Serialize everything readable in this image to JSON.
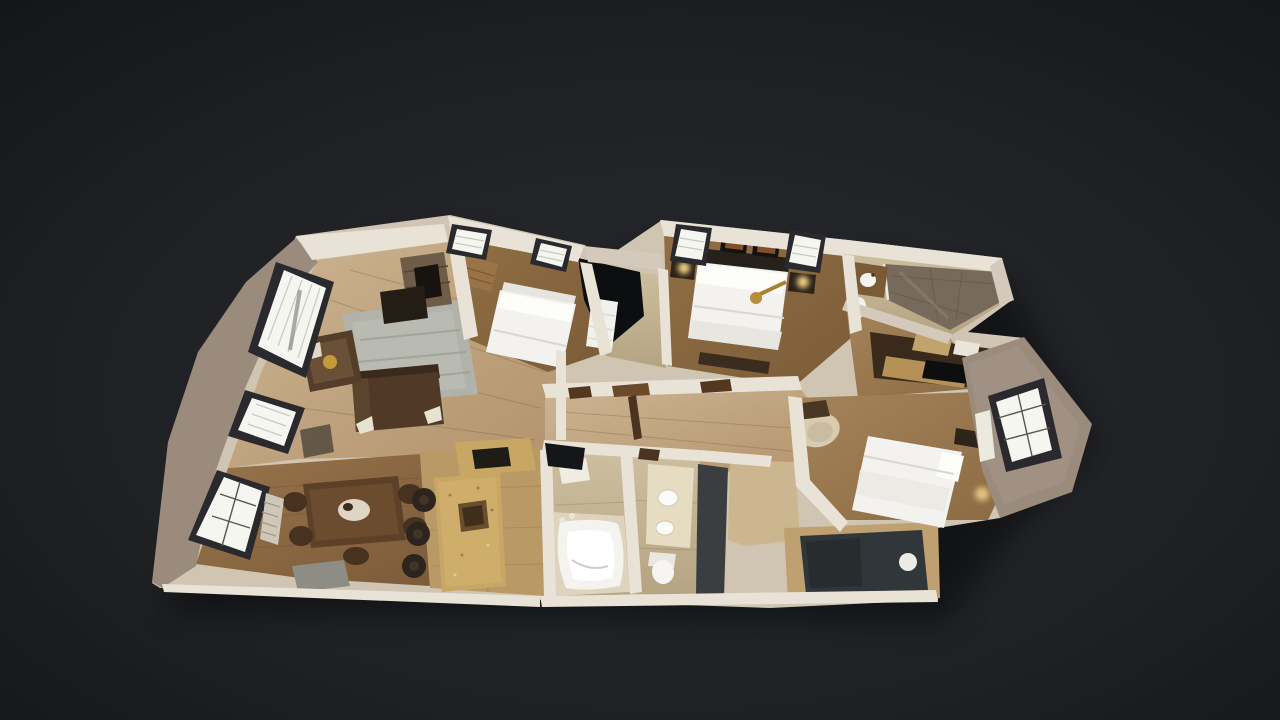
{
  "app": {
    "name": "3D virtual tour viewer",
    "view_mode": "Dollhouse view",
    "background_color": "#1d1f22"
  },
  "scene": {
    "type": "3d-dollhouse-floorplan",
    "description": "Overhead cutaway dollhouse view of a furnished single-story residence, tilted at an oblique angle against a dark charcoal background",
    "rooms": [
      {
        "id": "living-room",
        "label": "Living room",
        "floor": "light hardwood",
        "furniture": [
          "dark brown sectional sofa",
          "dark brown armchair with gold pillow",
          "gray area rug",
          "stone fireplace with media console"
        ],
        "windows": 2
      },
      {
        "id": "dining-room",
        "label": "Dining room",
        "floor": "brown hardwood",
        "furniture": [
          "dark wood dining table",
          "dining chairs",
          "white centerpiece",
          "gray side chair"
        ],
        "windows": 1
      },
      {
        "id": "kitchen",
        "label": "Kitchen",
        "floor": "tan tile",
        "furniture": [
          "granite island with sink",
          "three dark bar stools",
          "granite counter with cooktop"
        ],
        "windows": 0
      },
      {
        "id": "bedroom-front",
        "label": "Front bedroom",
        "floor": "brown carpet",
        "furniture": [
          "white double bed",
          "wood dresser"
        ],
        "windows": 2
      },
      {
        "id": "master-bedroom",
        "label": "Master bedroom",
        "floor": "brown carpet",
        "furniture": [
          "white king bed with dark headboard",
          "two framed pictures",
          "two nightstands with lamps",
          "brass ceiling fan"
        ],
        "windows": 2
      },
      {
        "id": "master-bathroom",
        "label": "Master bathroom",
        "floor": "beige tile",
        "furniture": [
          "tiled walk-in shower",
          "wood vanity with sink",
          "toilet"
        ],
        "windows": 0
      },
      {
        "id": "closet-hall",
        "label": "Closet / storage hall",
        "floor": "tan carpet",
        "furniture": [
          "dark wood wardrobe",
          "granite counter",
          "storage boxes"
        ],
        "windows": 0
      },
      {
        "id": "bedroom-right",
        "label": "Right bedroom",
        "floor": "tan carpet",
        "furniture": [
          "white double bed",
          "cream armchair",
          "desk",
          "nightstand"
        ],
        "windows": 1
      },
      {
        "id": "bathroom-tub",
        "label": "Bathroom with corner tub",
        "floor": "beige tile",
        "furniture": [
          "white corner jacuzzi tub",
          "towel shelf"
        ],
        "windows": 0
      },
      {
        "id": "hall-bathroom",
        "label": "Hall bathroom",
        "floor": "beige tile",
        "furniture": [
          "cream double-sink vanity",
          "toilet"
        ],
        "windows": 0
      },
      {
        "id": "hallway",
        "label": "Hallway",
        "floor": "light hardwood",
        "furniture": [
          "interior doors"
        ],
        "windows": 0
      },
      {
        "id": "utility-room",
        "label": "Utility room",
        "floor": "dark flooring",
        "furniture": [
          "water heater"
        ],
        "windows": 0
      }
    ],
    "palette": {
      "background": "#1d1f22",
      "interior_walls": "#e9e3d7",
      "exterior_wall": "#9a8b7d",
      "hardwood_light": "#c7ad8a",
      "hardwood_brown": "#8a6544",
      "carpet_brown": "#8a6a44",
      "carpet_tan": "#9c7c52",
      "tile_beige": "#c7b899",
      "granite": "#c8a765",
      "bedding_white": "#f3f2ee",
      "window_glow": "#f6f6f1",
      "window_frame": "#2a2a2e",
      "furniture_dark_wood": "#4a3422",
      "shower_tile": "#776a5c",
      "utility_floor": "#30363a"
    }
  }
}
